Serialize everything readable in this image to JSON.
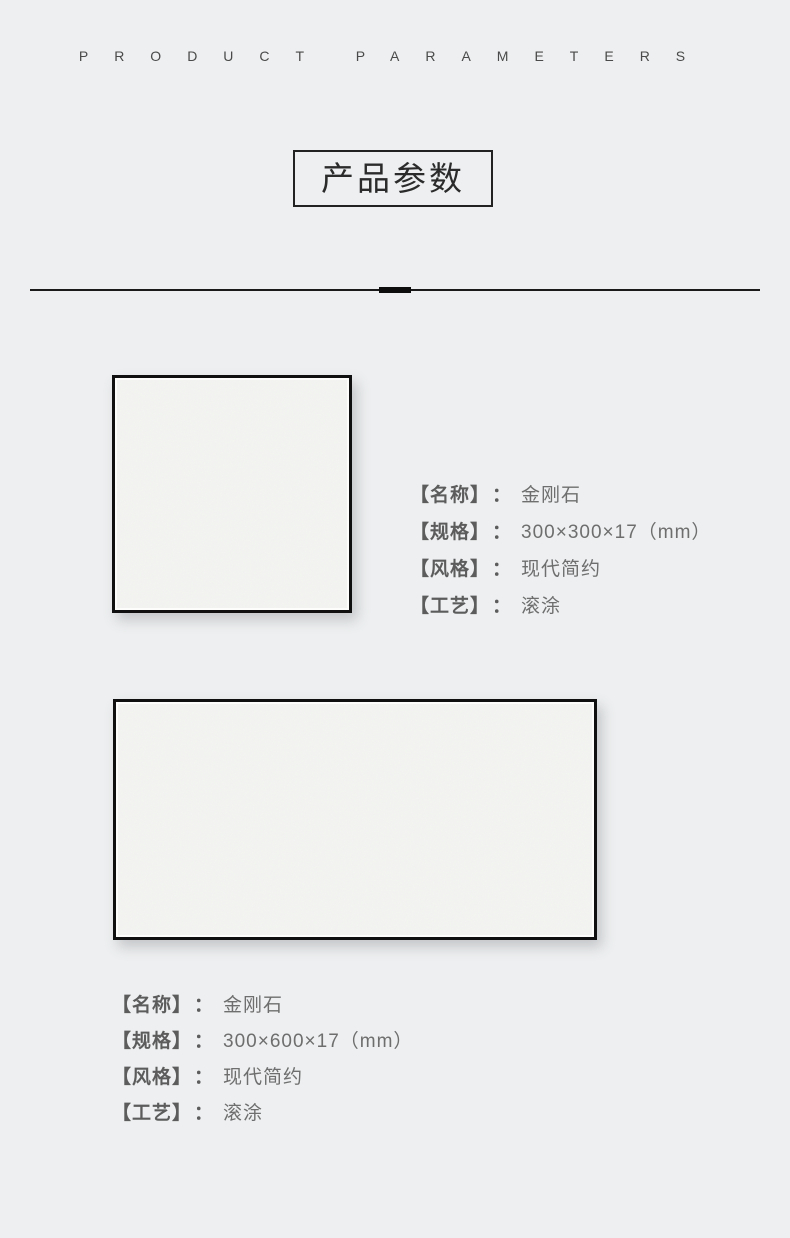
{
  "page": {
    "subtitle_en": "PRODUCT PARAMETERS",
    "title": "产品参数",
    "colon": "："
  },
  "colors": {
    "background": "#edeff0",
    "divider": "#1a1a1a",
    "title_text": "#2b2b2b",
    "title_border": "#222222",
    "spec_label": "#5c5c5c",
    "spec_value": "#6e6e6e",
    "tile_face": "#f3f4f1",
    "tile_border": "#101010"
  },
  "products": [
    {
      "image": "tile-swatch-300x300",
      "specs": [
        {
          "label": "【名称】",
          "value": "金刚石"
        },
        {
          "label": "【规格】",
          "value": "300×300×17（mm）"
        },
        {
          "label": "【风格】",
          "value": "现代简约"
        },
        {
          "label": "【工艺】",
          "value": "滚涂"
        }
      ]
    },
    {
      "image": "tile-swatch-300x600",
      "specs": [
        {
          "label": "【名称】",
          "value": "金刚石"
        },
        {
          "label": "【规格】",
          "value": "300×600×17（mm）"
        },
        {
          "label": "【风格】",
          "value": "现代简约"
        },
        {
          "label": "【工艺】",
          "value": "滚涂"
        }
      ]
    }
  ]
}
